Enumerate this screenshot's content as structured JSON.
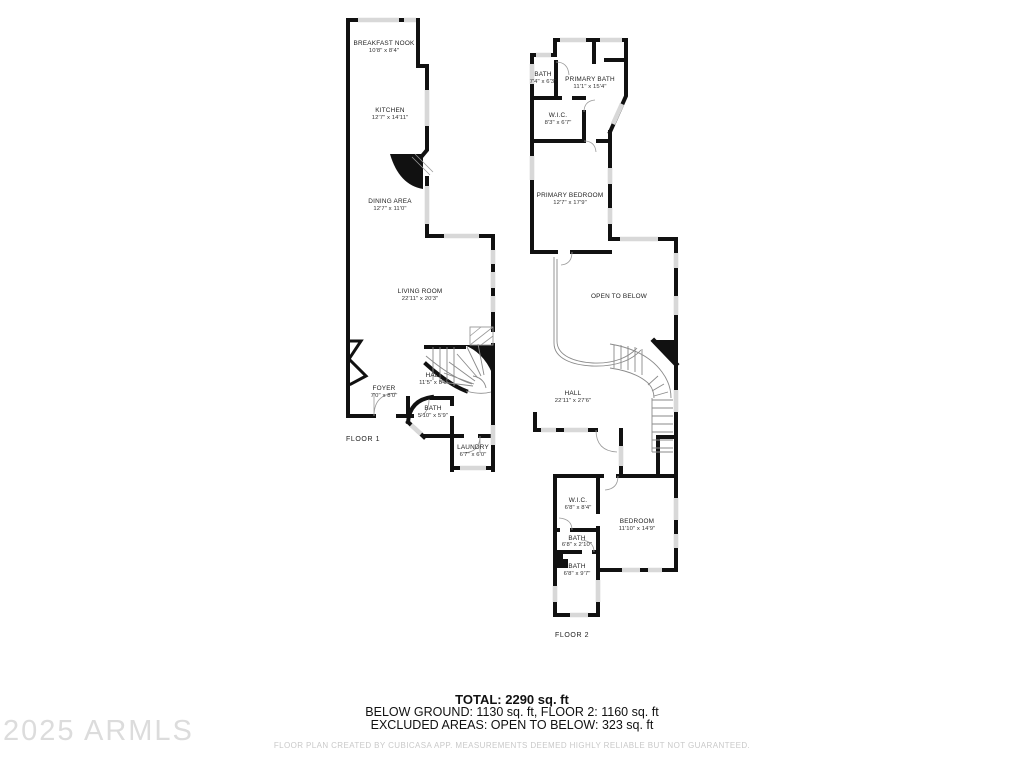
{
  "floor1": {
    "label": "FLOOR 1",
    "rooms": [
      {
        "name": "BREAKFAST NOOK",
        "dims": "10'8\" x 8'4\""
      },
      {
        "name": "KITCHEN",
        "dims": "12'7\" x 14'11\""
      },
      {
        "name": "DINING AREA",
        "dims": "12'7\" x 11'0\""
      },
      {
        "name": "LIVING ROOM",
        "dims": "22'11\" x 20'3\""
      },
      {
        "name": "FOYER",
        "dims": "7'0\" x 8'0\""
      },
      {
        "name": "HALL",
        "dims": "11'5\" x 8'0\""
      },
      {
        "name": "BATH",
        "dims": "5'10\" x 5'9\""
      },
      {
        "name": "LAUNDRY",
        "dims": "6'7\" x 6'0\""
      }
    ]
  },
  "floor2": {
    "label": "FLOOR 2",
    "rooms": [
      {
        "name": "BATH",
        "dims": "7'4\" x 6'3\""
      },
      {
        "name": "PRIMARY BATH",
        "dims": "11'1\" x 15'4\""
      },
      {
        "name": "W.I.C.",
        "dims": "8'3\" x 6'7\""
      },
      {
        "name": "PRIMARY BEDROOM",
        "dims": "12'7\" x 17'9\""
      },
      {
        "name": "OPEN TO BELOW",
        "dims": ""
      },
      {
        "name": "HALL",
        "dims": "22'11\" x 27'6\""
      },
      {
        "name": "W.I.C.",
        "dims": "6'8\" x 8'4\""
      },
      {
        "name": "BEDROOM",
        "dims": "11'10\" x 14'9\""
      },
      {
        "name": "BATH",
        "dims": "6'8\" x 2'10\""
      },
      {
        "name": "BATH",
        "dims": "6'8\" x 9'7\""
      }
    ]
  },
  "summary": {
    "total": "TOTAL: 2290 sq. ft",
    "breakdown": "BELOW GROUND: 1130 sq. ft, FLOOR 2: 1160 sq. ft",
    "excluded": "EXCLUDED AREAS: OPEN TO BELOW: 323 sq. ft"
  },
  "footer": {
    "disclaimer": "FLOOR PLAN CREATED BY CUBICASA APP. MEASUREMENTS DEEMED HIGHLY RELIABLE BUT NOT GUARANTEED."
  },
  "watermark": {
    "text": "2025 ARMLS"
  },
  "colors": {
    "wall": "#111111",
    "window": "#d8d8d8",
    "thin_line": "#8a8a8a",
    "text": "#222222",
    "watermark": "#dcdcdc",
    "footer_text": "#c9c9c9"
  }
}
